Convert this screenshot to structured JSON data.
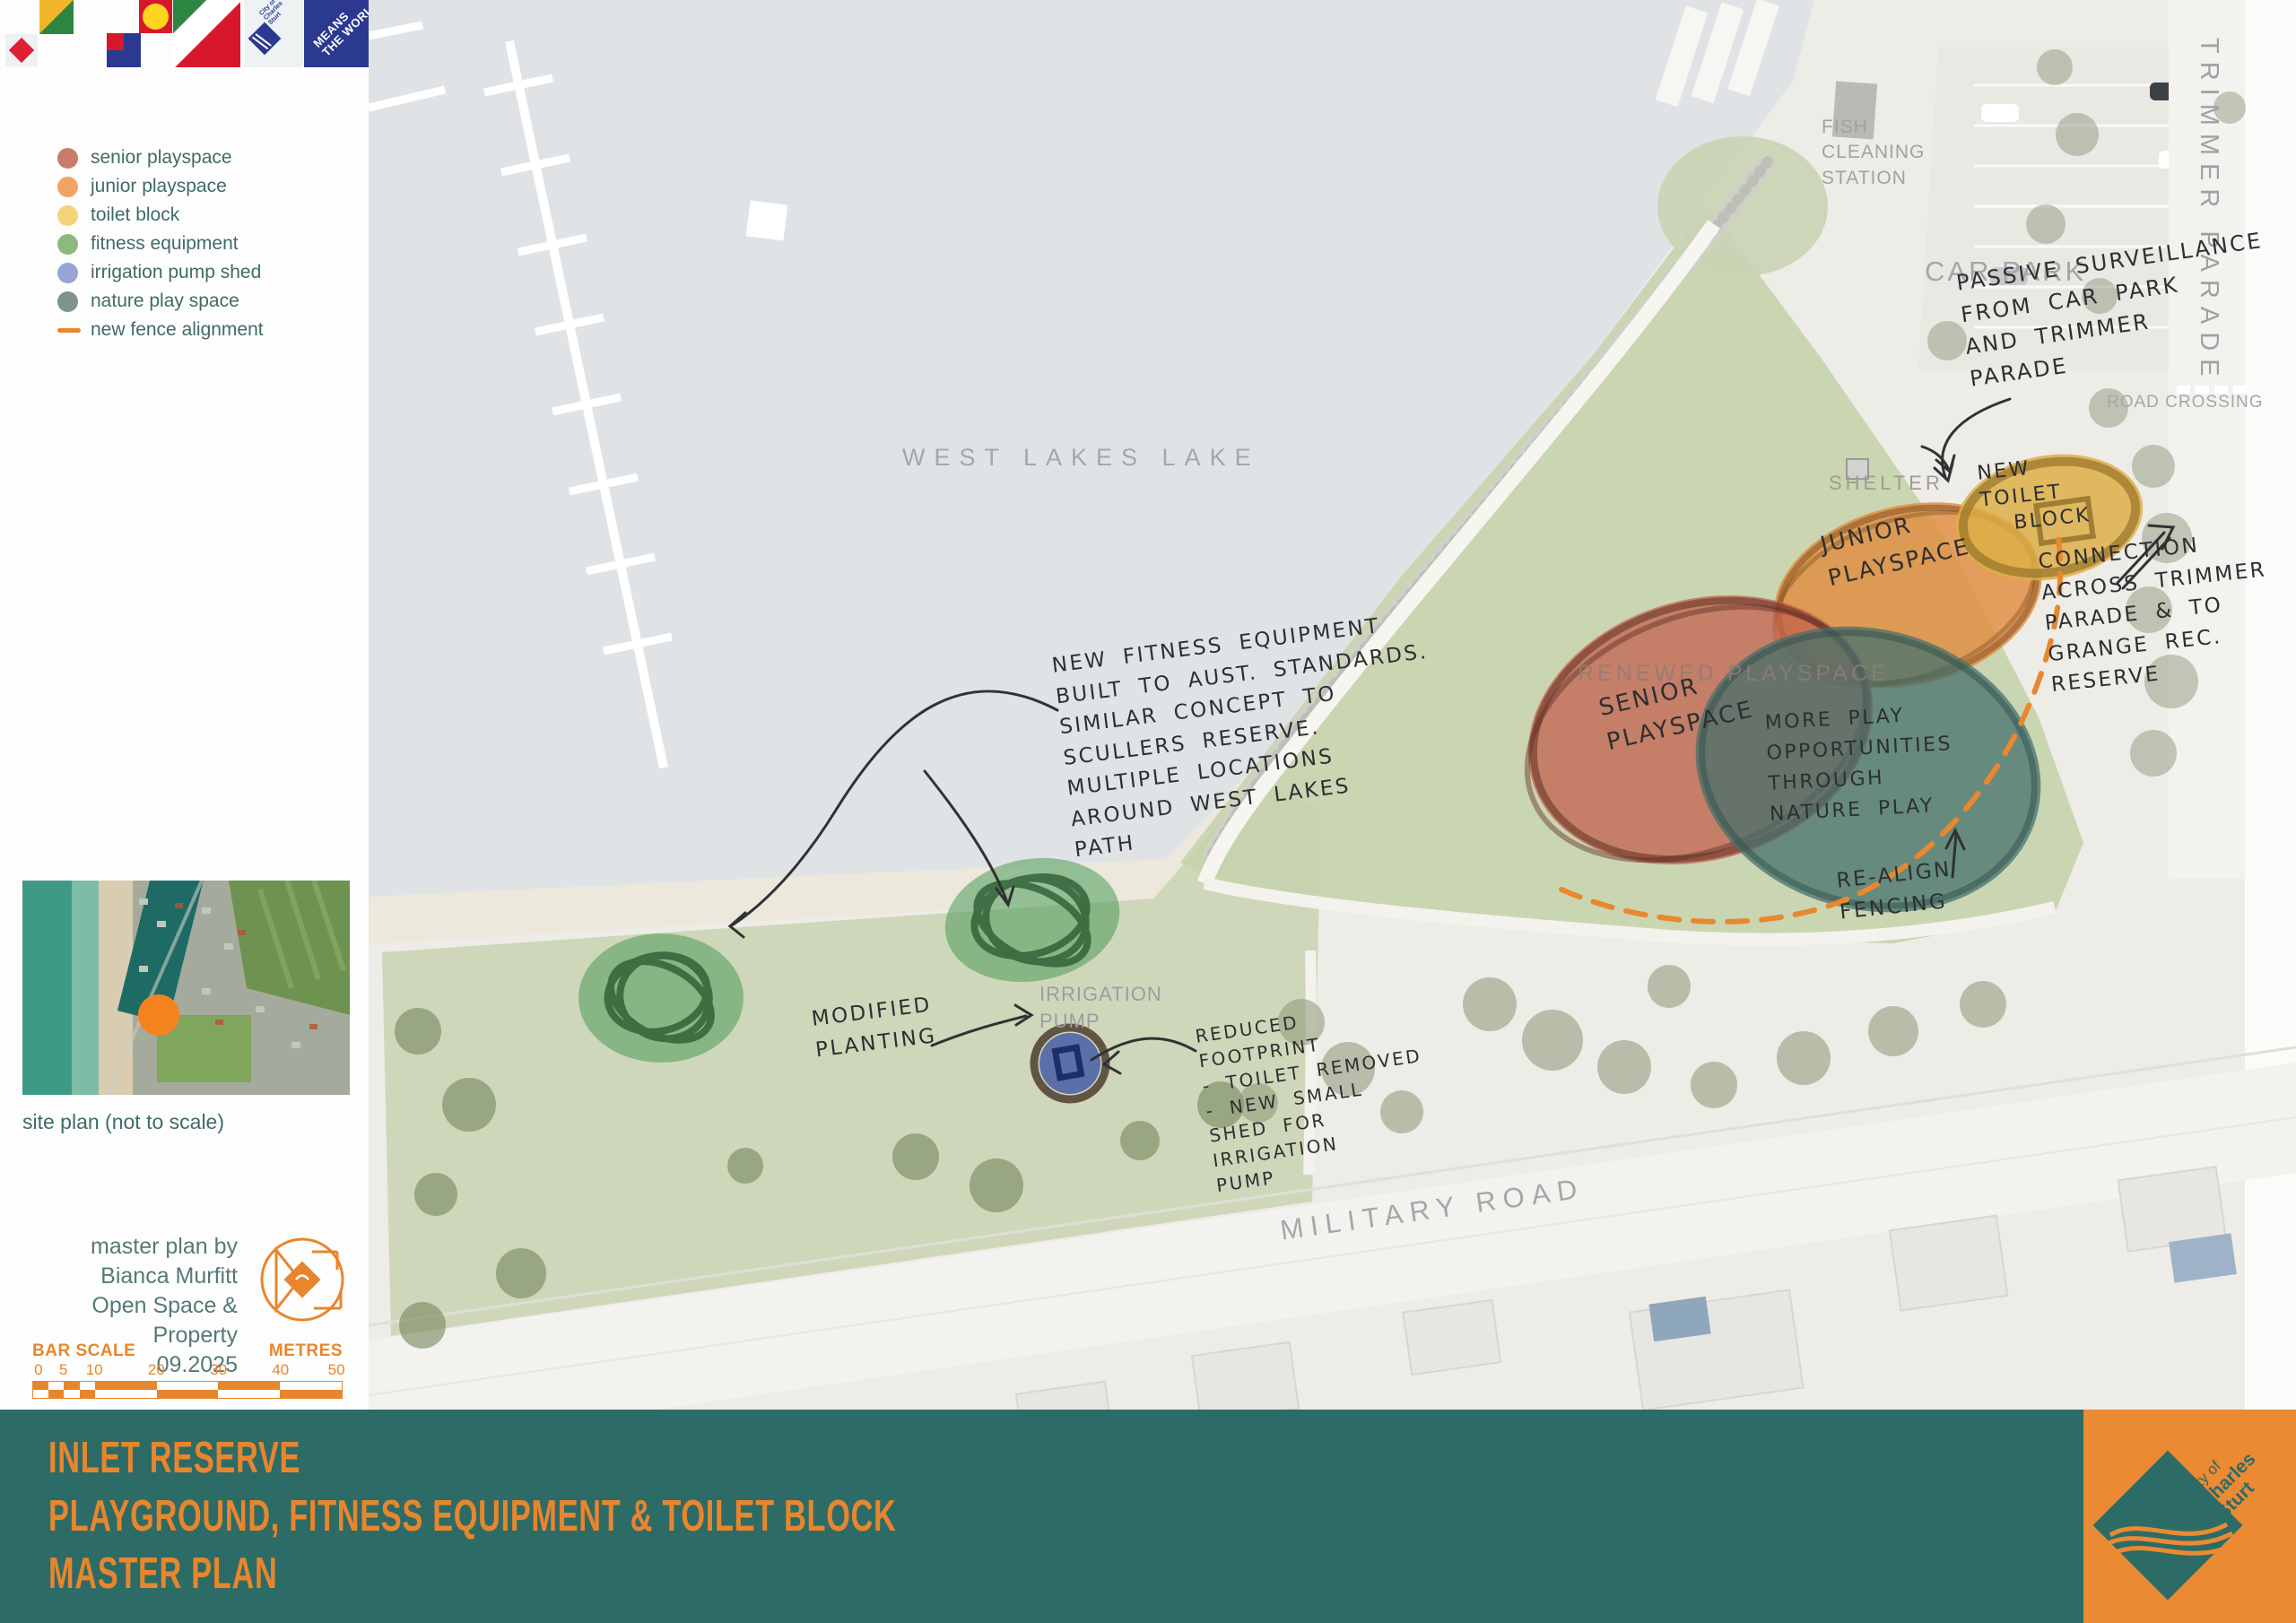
{
  "brand": {
    "city_logo_label": "City of Charles Sturt",
    "tagline": "MEANS\nTHE WORLD"
  },
  "legend": {
    "items": [
      {
        "label": "senior playspace",
        "color": "#c97c6b"
      },
      {
        "label": "junior playspace",
        "color": "#f0a463"
      },
      {
        "label": "toilet block",
        "color": "#f6d379"
      },
      {
        "label": "fitness equipment",
        "color": "#8cba7d"
      },
      {
        "label": "irrigation pump shed",
        "color": "#98a3d8"
      },
      {
        "label": "nature play space",
        "color": "#7f948c"
      },
      {
        "label": "new fence alignment",
        "color": "#e8872e"
      }
    ]
  },
  "site_plan": {
    "caption": "site plan (not to scale)"
  },
  "credits": {
    "line1": "master plan by",
    "line2": "Bianca Murfitt",
    "line3": "Open Space & Property",
    "line4": "09.2025"
  },
  "bar_scale": {
    "label": "BAR SCALE",
    "unit": "METRES",
    "ticks": [
      "0",
      "5",
      "10",
      "20",
      "30",
      "40",
      "50"
    ]
  },
  "map": {
    "labels": {
      "lake": "WEST LAKES LAKE",
      "car_park": "CAR PARK",
      "fish_cleaning": "FISH\nCLEANING\nSTATION",
      "road_crossing": "ROAD CROSSING",
      "trimmer_parade": "TRIMMER PARADE",
      "shelter": "SHELTER",
      "renewed_playspace": "RENEWED PLAYSPACE",
      "irrigation_pump": "IRRIGATION\nPUMP",
      "military_road": "MILITARY ROAD"
    },
    "annotations": {
      "fitness": "NEW FITNESS EQUIPMENT\nBUILT TO AUST. STANDARDS.\nSIMILAR CONCEPT TO\nSCULLERS RESERVE.\nMULTIPLE LOCATIONS\nAROUND WEST LAKES\nPATH",
      "passive_surveillance": "PASSIVE SURVEILLANCE\nFROM CAR PARK\nAND TRIMMER\nPARADE",
      "new_toilet_block": "NEW\nTOILET\n  BLOCK",
      "junior_playspace": "JUNIOR\nPLAYSPACE",
      "senior_playspace": "SENIOR\nPLAYSPACE",
      "nature_play": "MORE PLAY\nOPPORTUNITIES\nTHROUGH\nNATURE PLAY",
      "connection": "CONNECTION\nACROSS TRIMMER\nPARADE & TO\nGRANGE REC.\nRESERVE",
      "realign_fencing": "RE-ALIGN\nFENCING",
      "modified_planting": "MODIFIED\nPLANTING",
      "reduced_footprint": "REDUCED\nFOOTPRINT\n- TOILET REMOVED\n- NEW SMALL\nSHED FOR\nIRRIGATION\nPUMP"
    }
  },
  "footer": {
    "line1": "INLET RESERVE",
    "line2": "PLAYGROUND, FITNESS EQUIPMENT & TOILET BLOCK",
    "line3": "MASTER PLAN",
    "logo_label_top": "City of",
    "logo_label_mid": "Charles",
    "logo_label_bottom": "Sturt"
  },
  "colors": {
    "footer_teal": "#2d6b67",
    "accent_orange": "#e8862d",
    "map_label_gray": "#a4a7aa",
    "handwriting": "#2d2f31",
    "senior_fill": "#c4604d",
    "junior_fill": "#e08b3c",
    "toilet_fill": "#ddaf46",
    "fitness_fill": "#4c9a57",
    "pump_fill": "#3d55a5",
    "nature_fill": "#44706c",
    "fence_orange": "#e8882f"
  }
}
